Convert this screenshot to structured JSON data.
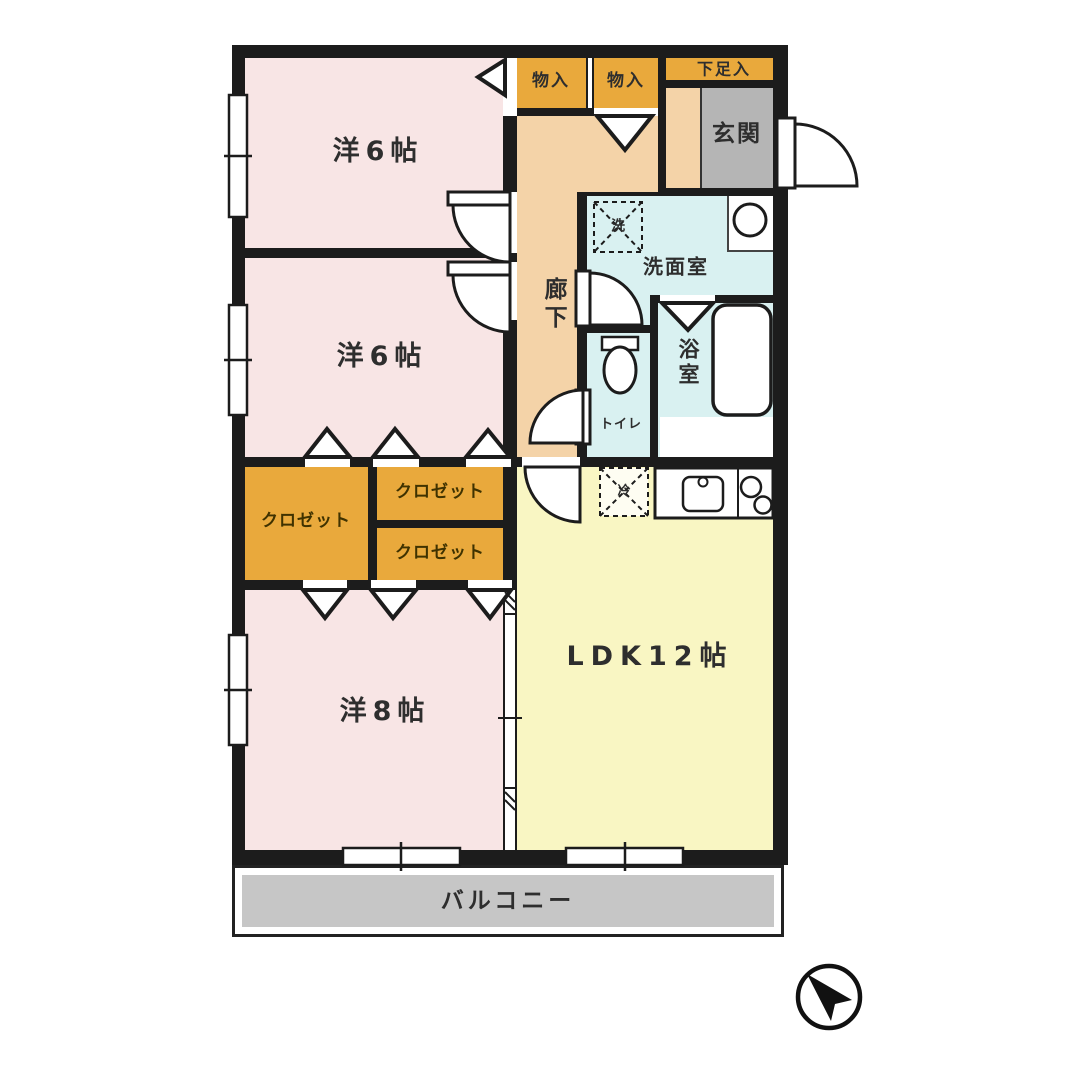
{
  "plan_title": "3LDK apartment floor plan",
  "colors": {
    "wall": "#1c1c1c",
    "bedroom_pink": "#F8E5E5",
    "ldk_yellow": "#F9F6C3",
    "corridor_peach": "#F4D3A8",
    "wet_area_cyan": "#D9F1F1",
    "closet_orange": "#E9A93C",
    "entrance_gray": "#B5B5B5",
    "balcony_gray": "#C6C6C6"
  },
  "rooms": {
    "bedroom1": {
      "label": "洋6帖"
    },
    "bedroom2": {
      "label": "洋6帖"
    },
    "bedroom3": {
      "label": "洋8帖"
    },
    "ldk": {
      "label": "LDK12帖"
    },
    "corridor": {
      "label": "廊下"
    },
    "entrance": {
      "label": "玄関"
    },
    "shoe_storage": {
      "label": "下足入"
    },
    "storage1": {
      "label": "物入"
    },
    "storage2": {
      "label": "物入"
    },
    "washroom": {
      "label": "洗面室"
    },
    "bath": {
      "label": "浴室"
    },
    "toilet": {
      "label": "トイレ"
    },
    "closet1": {
      "label": "クロゼット"
    },
    "closet2": {
      "label": "クロゼット"
    },
    "closet3": {
      "label": "クロゼット"
    },
    "balcony": {
      "label": "バルコニー"
    }
  },
  "fixtures": {
    "washing_machine": {
      "label": "洗"
    },
    "refrigerator": {
      "label": "冷"
    }
  },
  "icons": {
    "compass": "north-arrow"
  }
}
